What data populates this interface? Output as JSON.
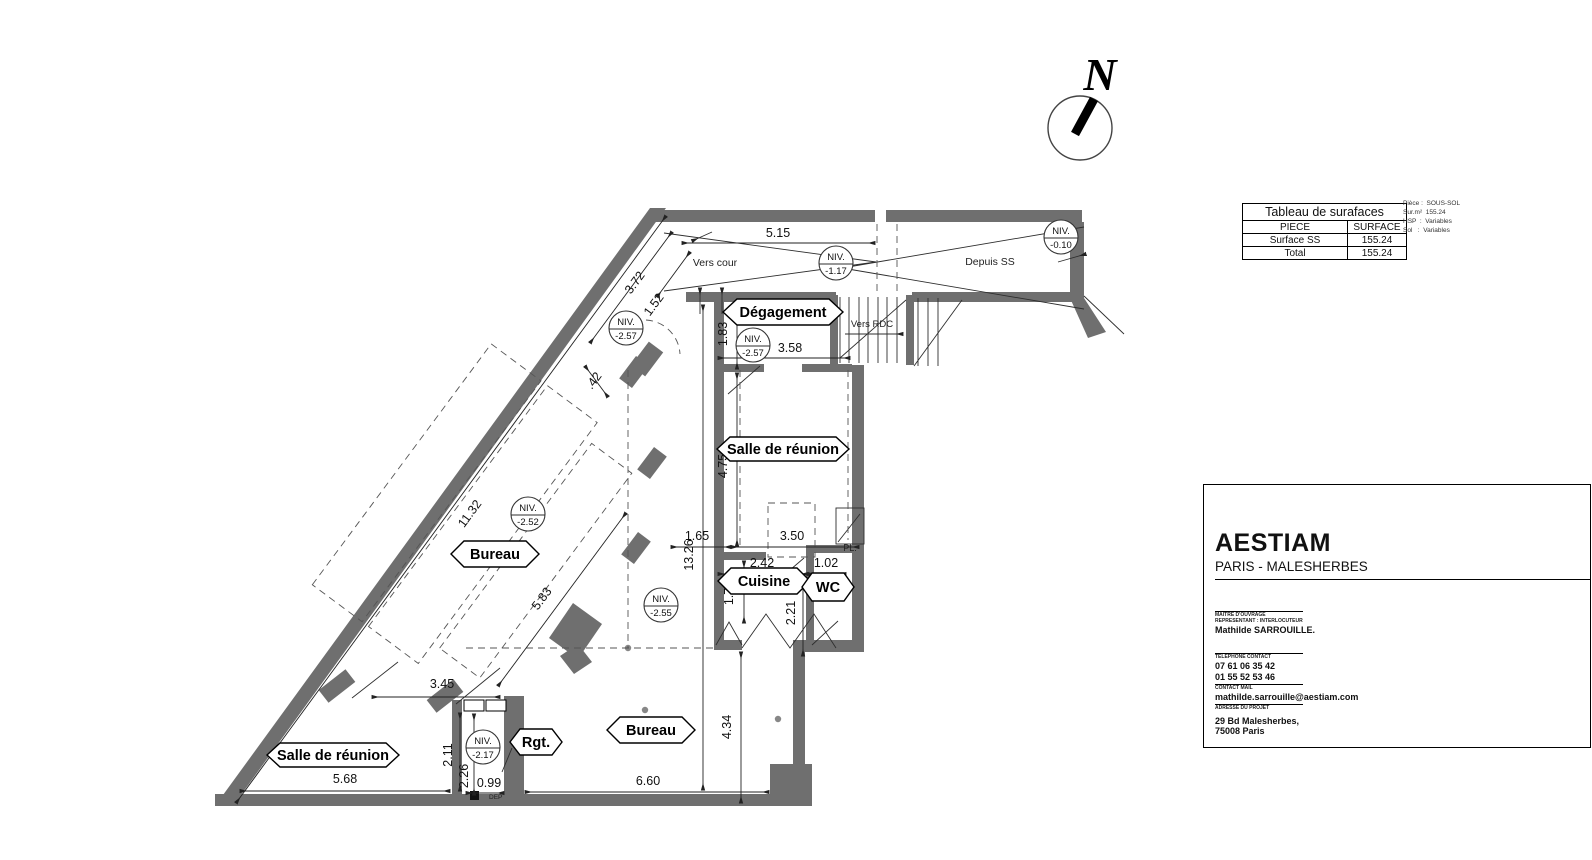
{
  "surface_table": {
    "title": "Tableau de surafaces",
    "col_piece": "PIECE",
    "col_surface": "SURFACE",
    "rows": [
      {
        "piece": "Surface SS",
        "surface": "155.24"
      },
      {
        "piece": "Total",
        "surface": "155.24"
      }
    ],
    "notes": {
      "line1": "Pièce :  SOUS-SOL",
      "line2": "Sur.m²  155.24",
      "line3": "HSP  :  Variables",
      "line4": "Sol   :  Variables"
    }
  },
  "title_block": {
    "company": "AESTIAM",
    "project": "PARIS - MALESHERBES",
    "owner_label1": "MAITRE D'OUVRAGE",
    "owner_label2": "REPRESENTANT : INTERLOCUTEUR",
    "owner_name": "Mathilde SARROUILLE.",
    "phone_label": "TELEPHONE CONTACT",
    "phone1": "07 61 06 35 42",
    "phone2": "01 55 52 53 46",
    "mail_label": "CONTACT MAIL",
    "mail": "mathilde.sarrouille@aestiam.com",
    "address_label": "ADRESSE DU PROJET",
    "address1": "29 Bd Malesherbes,",
    "address2": "75008 Paris"
  },
  "compass": {
    "north": "N"
  },
  "plan": {
    "niv_label": "NIV.",
    "niv_values": [
      "-1.17",
      "-0.10",
      "-2.57",
      "-2.57",
      "-2.52",
      "-2.55",
      "-2.17"
    ],
    "rooms": [
      "Dégagement",
      "Salle de réunion",
      "Bureau",
      "Cuisine",
      "WC",
      "Salle de réunion",
      "Rgt.",
      "Bureau"
    ],
    "dims": [
      "5.15",
      "3.72",
      "1.52",
      ".42",
      "11.32",
      "5.83",
      "3.45",
      "5.68",
      "2.11",
      "2.26",
      "0.99",
      "6.60",
      "4.34",
      "1.83",
      "3.58",
      "4.75",
      "1.65",
      "3.50",
      "13.26",
      "2.42",
      "1.02",
      "1.74",
      "2.21"
    ],
    "ann": {
      "vers_cour": "Vers cour",
      "depuis_ss": "Depuis SS",
      "vers_rdc": "Vers RDC",
      "pl": "PL.",
      "dep": "DEP"
    }
  }
}
